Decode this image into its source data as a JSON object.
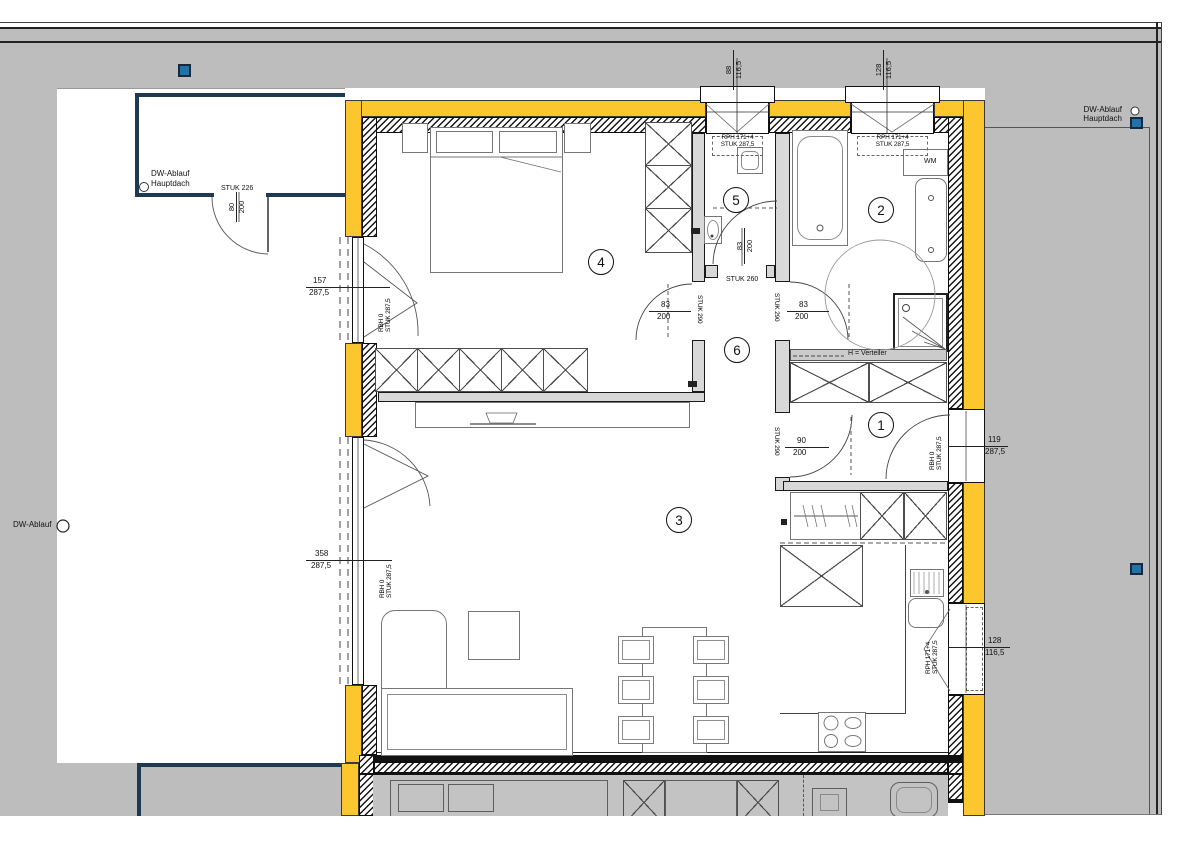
{
  "drawing": {
    "type": "apartment-floor-plan",
    "labels": {
      "dw_ablauf": "DW-Ablauf",
      "hauptdach": "Hauptdach",
      "wm": "WM",
      "verteiler": "H = Verteiler"
    },
    "rooms": {
      "r1": "1",
      "r2": "2",
      "r3": "3",
      "r4": "4",
      "r5": "5",
      "r6": "6"
    },
    "dims": {
      "balcony_gate": {
        "stuk": "STUK 226",
        "w": "80",
        "h": "200"
      },
      "bedroom_terrace_door": {
        "w": "157",
        "h": "287,5",
        "note1": "RBH 0",
        "note2": "STUK 287,5"
      },
      "living_terrace_door": {
        "w": "358",
        "h": "287,5",
        "note1": "RBH 0",
        "note2": "STUK 287,5"
      },
      "entrance_door": {
        "w": "119",
        "h": "287,5",
        "note1": "RBH 0",
        "note2": "STUK 287,5"
      },
      "wc_window": {
        "w": "88",
        "h": "116,5",
        "note1": "RPH 171+4",
        "note2": "STUK 287,5"
      },
      "bath_window": {
        "w": "128",
        "h": "116,5",
        "note1": "RPH 171+4",
        "note2": "STUK 287,5"
      },
      "kitchen_window": {
        "w": "128",
        "h": "116,5",
        "note1": "RPH 171+4",
        "note2": "STUK 287,5"
      },
      "bedroom_door": {
        "w": "83",
        "h": "200",
        "stuk": "STUK 290"
      },
      "bath_door": {
        "w": "83",
        "h": "200",
        "stuk": "STUK 290"
      },
      "hall_door": {
        "w": "90",
        "h": "200",
        "stuk": "STUK 290"
      },
      "wc_door": {
        "w": "83",
        "h": "200",
        "stuk": "STUK 260"
      }
    },
    "colors": {
      "insulation": "#FCC62F",
      "roof_gray": "#BDBDBD",
      "parapet_navy": "#1D3A52",
      "drain_blue": "#2272A8"
    }
  }
}
